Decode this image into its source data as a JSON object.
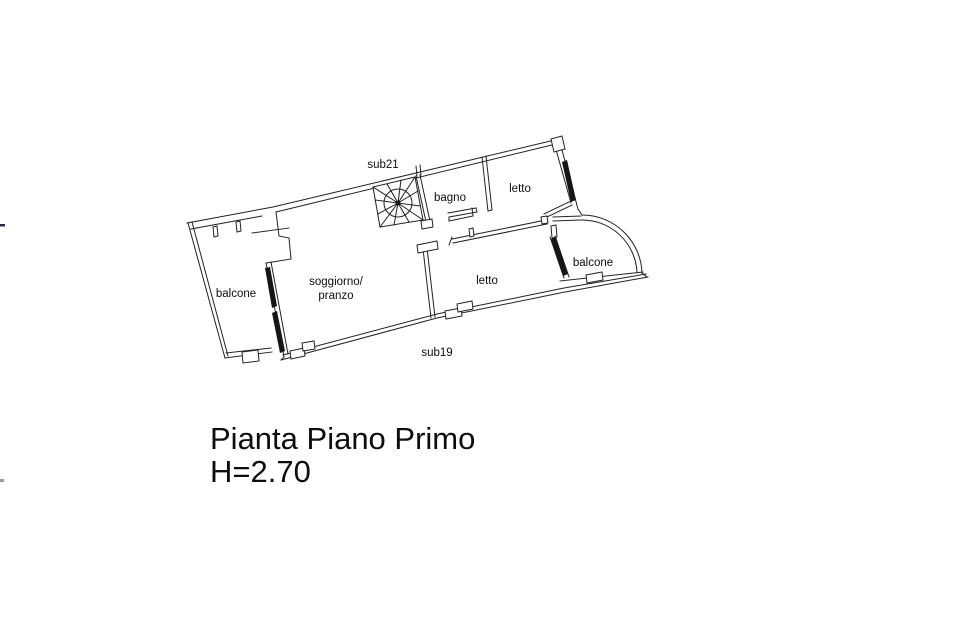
{
  "floor_plan": {
    "unit_labels": {
      "top": "sub21",
      "bottom": "sub19"
    },
    "rooms": {
      "bagno": "bagno",
      "letto_top": "letto",
      "letto_bottom": "letto",
      "balcone_left": "balcone",
      "balcone_right": "balcone",
      "soggiorno_line1": "soggiorno/",
      "soggiorno_line2": "pranzo"
    }
  },
  "caption": {
    "line1": "Pianta Piano Primo",
    "line2": "H=2.70"
  },
  "colors": {
    "line": "#222222",
    "text": "#0d0d0d",
    "background": "#ffffff"
  }
}
